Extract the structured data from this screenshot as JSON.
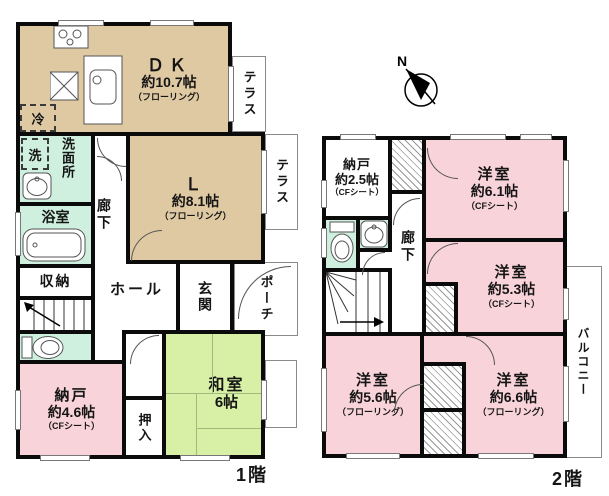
{
  "floor1": {
    "caption": "1階",
    "dk": {
      "name": "ＤＫ",
      "size": "約10.7帖",
      "finish": "（フローリング）"
    },
    "living": {
      "name": "Ｌ",
      "size": "約8.1帖",
      "finish": "（フローリング）"
    },
    "terrace_top": {
      "label": "テラス"
    },
    "terrace_right": {
      "label": "テラス"
    },
    "fridge": {
      "label": "冷"
    },
    "washer": {
      "label": "洗"
    },
    "washroom": {
      "label": "洗面所"
    },
    "bathroom": {
      "label": "浴室"
    },
    "storage": {
      "label": "収納"
    },
    "corridor": {
      "label": "廊下"
    },
    "hall": {
      "label": "ホール"
    },
    "entrance": {
      "label": "玄関"
    },
    "porch": {
      "label": "ポーチ"
    },
    "storeroom": {
      "name": "納戸",
      "size": "約4.6帖",
      "finish": "（CFシート）"
    },
    "oshiire": {
      "label": "押入"
    },
    "japanese_room": {
      "name": "和室",
      "size": "6帖"
    }
  },
  "floor2": {
    "caption": "2階",
    "storeroom": {
      "name": "納戸",
      "size": "約2.5帖",
      "finish": "（CFシート）"
    },
    "bedroom_61": {
      "name": "洋室",
      "size": "約6.1帖",
      "finish": "（CFシート）"
    },
    "bedroom_53": {
      "name": "洋室",
      "size": "約5.3帖",
      "finish": "（CFシート）"
    },
    "bedroom_56": {
      "name": "洋室",
      "size": "約5.6帖",
      "finish": "（フローリング）"
    },
    "bedroom_66": {
      "name": "洋室",
      "size": "約6.6帖",
      "finish": "（フローリング）"
    },
    "corridor": {
      "label": "廊下"
    },
    "balcony": {
      "label": "バルコニー"
    }
  },
  "compass": {
    "label": "N"
  },
  "colors": {
    "wall": "#0b0b0b",
    "wood_room": "#dfc9a3",
    "pink_room": "#f8d3da",
    "wet_room": "#cfefdf",
    "tatami_room": "#d8f0a6",
    "outline_gray": "#8a8a8a"
  }
}
